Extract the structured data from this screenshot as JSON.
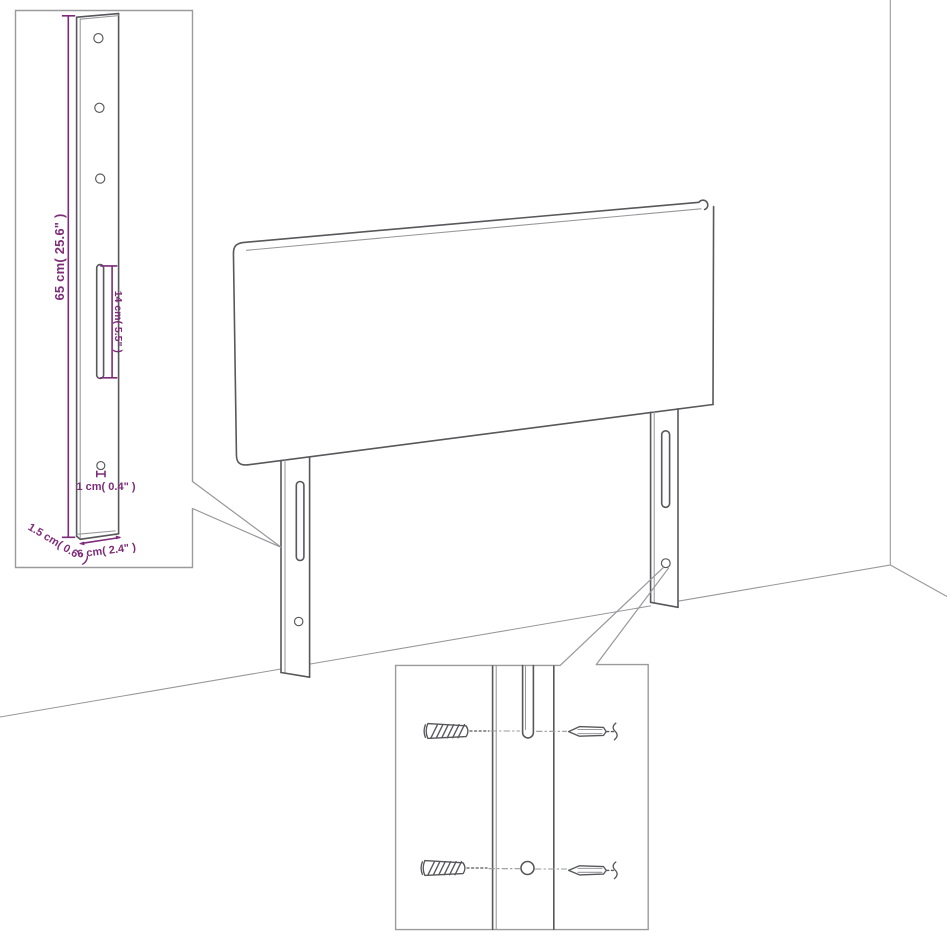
{
  "colors": {
    "background": "#ffffff",
    "line": "#57585b",
    "line_light": "#97989b",
    "box_border": "#9b9b9d",
    "dimension": "#7e2c79"
  },
  "leg_detail_inset": {
    "dim_height": "65 cm( 25.6\" )",
    "dim_slot_length": "14 cm( 5.5\" )",
    "dim_hole_diameter": "1 cm( 0.4\" )",
    "dim_side_thickness": "1.5 cm( 0.6\" )",
    "dim_leg_width": "6 cm( 2.4\" )"
  }
}
